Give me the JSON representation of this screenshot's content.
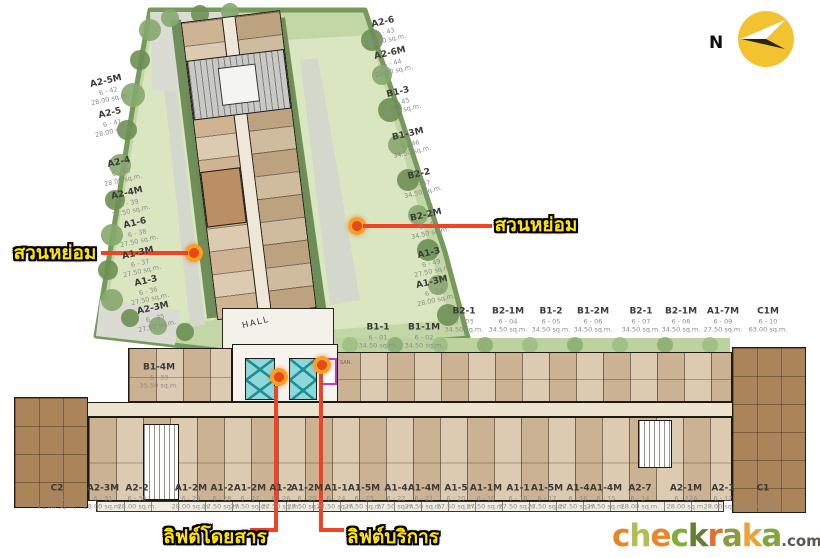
{
  "compass": {
    "n_label": "N"
  },
  "plan": {
    "hall_label": "HALL",
    "san_label": "SAN."
  },
  "colors": {
    "callout_yellow": "#ffe400",
    "connector_red": "#ef4323",
    "marker_orange_ring": "#f7a21f",
    "marker_red_core": "#e8481c",
    "lift_cyan": "#8ed8da",
    "compass_yellow": "#f2c230",
    "lawn_green": "#c3d6a6",
    "hedge_green": "#76995c",
    "unit_tan": "#d8c5a7",
    "corner_block_brown": "#ab845a"
  },
  "callouts": {
    "garden_left": "สวนหย่อม",
    "garden_right": "สวนหย่อม",
    "lift_passenger": "ลิฟต์โดยสาร",
    "lift_service": "ลิฟต์บริการ"
  },
  "units": {
    "left_column": [
      {
        "name": "A2-5M",
        "no": "6 - 42",
        "area": "28.00 sq.m.",
        "x": 108,
        "y": 90
      },
      {
        "name": "A2-5",
        "no": "6 - 41",
        "area": "28.00 sq.m.",
        "x": 112,
        "y": 122
      },
      {
        "name": "A2-4",
        "no": "6 - 40",
        "area": "28.00 sq.m.",
        "x": 121,
        "y": 171
      },
      {
        "name": "A2-4M",
        "no": "6 - 39",
        "area": "27.50 sq.m.",
        "x": 129,
        "y": 202
      },
      {
        "name": "A1-6",
        "no": "6 - 38",
        "area": "27.50 sq.m.",
        "x": 137,
        "y": 232
      },
      {
        "name": "A1-3M",
        "no": "6 - 37",
        "area": "27.50 sq.m.",
        "x": 140,
        "y": 262
      },
      {
        "name": "A1-3",
        "no": "6 - 36",
        "area": "27.50 sq.m.",
        "x": 148,
        "y": 290
      },
      {
        "name": "A2-3M",
        "no": "6 - 35",
        "area": "27.50 sq.m.",
        "x": 155,
        "y": 317
      }
    ],
    "right_column": [
      {
        "name": "A2-6",
        "no": "6 - 43",
        "area": "28.00 sq.m.",
        "x": 385,
        "y": 31
      },
      {
        "name": "A2-6M",
        "no": "6 - 44",
        "area": "28.00 sq.m.",
        "x": 392,
        "y": 62
      },
      {
        "name": "B1-3",
        "no": "6 - 45",
        "area": "34.50 sq.m.",
        "x": 400,
        "y": 101
      },
      {
        "name": "B1-3M",
        "no": "6 - 46",
        "area": "34.50 sq.m.",
        "x": 410,
        "y": 143
      },
      {
        "name": "B2-2",
        "no": "6 - 47",
        "area": "34.50 sq.m.",
        "x": 421,
        "y": 183
      },
      {
        "name": "B2-2M",
        "no": "6 - 48",
        "area": "34.50 sq.m.",
        "x": 428,
        "y": 224
      },
      {
        "name": "A1-3",
        "no": "6 - 49",
        "area": "27.50 sq.m.",
        "x": 431,
        "y": 262
      },
      {
        "name": "A1-3M",
        "no": "6 - 50",
        "area": "28.00 sq.m.",
        "x": 434,
        "y": 291
      }
    ],
    "wing_base": [
      {
        "name": "B1-1",
        "no": "6 - 01",
        "area": "34.50 sq.m.",
        "x": 378,
        "y": 336
      },
      {
        "name": "B1-1M",
        "no": "6 - 02",
        "area": "34.50 sq.m.",
        "x": 424,
        "y": 336
      }
    ],
    "misc": [
      {
        "name": "B1-4M",
        "no": "6 - 33",
        "area": "35.50 sq.m.",
        "x": 159,
        "y": 376
      }
    ],
    "top_row": [
      {
        "name": "B2-1",
        "no": "6 - 03",
        "area": "34.50 sq.m.",
        "x": 464,
        "y": 320
      },
      {
        "name": "B2-1M",
        "no": "6 - 04",
        "area": "34.50 sq.m.",
        "x": 508,
        "y": 320
      },
      {
        "name": "B1-2",
        "no": "6 - 05",
        "area": "34.50 sq.m.",
        "x": 551,
        "y": 320
      },
      {
        "name": "B1-2M",
        "no": "6 - 06",
        "area": "34.50 sq.m.",
        "x": 593,
        "y": 320
      },
      {
        "name": "B2-1",
        "no": "6 - 07",
        "area": "34.50 sq.m.",
        "x": 641,
        "y": 320
      },
      {
        "name": "B2-1M",
        "no": "6 - 08",
        "area": "34.50 sq.m.",
        "x": 681,
        "y": 320
      },
      {
        "name": "A1-7M",
        "no": "6 - 09",
        "area": "27.50 sq.m.",
        "x": 723,
        "y": 320
      },
      {
        "name": "C1M",
        "no": "6 - 10",
        "area": "63.00 sq.m.",
        "x": 768,
        "y": 320
      }
    ],
    "bottom_row": [
      {
        "name": "C2",
        "no": "6 - 32",
        "area": "71.00 sq.m.",
        "x": 57,
        "y": 497
      },
      {
        "name": "A2-3M",
        "no": "6 - 31",
        "area": "28.00 sq.m.",
        "x": 103,
        "y": 497
      },
      {
        "name": "A2-2",
        "no": "6 - 30",
        "area": "28.00 sq.m.",
        "x": 137,
        "y": 497
      },
      {
        "name": "A1-2M",
        "no": "6 - 29",
        "area": "28.00 sq.m.",
        "x": 191,
        "y": 497
      },
      {
        "name": "A1-2",
        "no": "6 - 28",
        "area": "27.50 sq.m.",
        "x": 222,
        "y": 497
      },
      {
        "name": "A1-2M",
        "no": "6 - 27",
        "area": "27.50 sq.m.",
        "x": 250,
        "y": 497
      },
      {
        "name": "A1-2",
        "no": "6 - 26",
        "area": "27.50 sq.m.",
        "x": 281,
        "y": 497
      },
      {
        "name": "A1-2M",
        "no": "6 - 25",
        "area": "27.50 sq.m.",
        "x": 307,
        "y": 497
      },
      {
        "name": "A1-1",
        "no": "6 - 24",
        "area": "27.50 sq.m.",
        "x": 336,
        "y": 497
      },
      {
        "name": "A1-5M",
        "no": "6 - 23",
        "area": "27.50 sq.m.",
        "x": 364,
        "y": 497
      },
      {
        "name": "A1-4",
        "no": "6 - 22",
        "area": "27.50 sq.m.",
        "x": 396,
        "y": 497
      },
      {
        "name": "A1-4M",
        "no": "6 - 21",
        "area": "27.50 sq.m.",
        "x": 424,
        "y": 497
      },
      {
        "name": "A1-5",
        "no": "6 - 20",
        "area": "27.50 sq.m.",
        "x": 456,
        "y": 497
      },
      {
        "name": "A1-1M",
        "no": "6 - 19",
        "area": "27.50 sq.m.",
        "x": 486,
        "y": 497
      },
      {
        "name": "A1-1",
        "no": "6 - 18",
        "area": "27.50 sq.m.",
        "x": 518,
        "y": 497
      },
      {
        "name": "A1-5M",
        "no": "6 - 17",
        "area": "27.50 sq.m.",
        "x": 547,
        "y": 497
      },
      {
        "name": "A1-4",
        "no": "6 - 16",
        "area": "27.50 sq.m.",
        "x": 578,
        "y": 497
      },
      {
        "name": "A1-4M",
        "no": "6 - 15",
        "area": "27.50 sq.m.",
        "x": 606,
        "y": 497
      },
      {
        "name": "A2-7",
        "no": "6 - 14",
        "area": "28.00 sq.m.",
        "x": 640,
        "y": 497
      },
      {
        "name": "A2-1M",
        "no": "6 - 12A",
        "area": "28.00 sq.m.",
        "x": 686,
        "y": 497
      },
      {
        "name": "A2-1",
        "no": "6 - 12",
        "area": "28.00 sq.m.",
        "x": 723,
        "y": 497
      },
      {
        "name": "C1",
        "no": "6 - 11",
        "area": "63.00 sq.m.",
        "x": 763,
        "y": 497
      }
    ]
  },
  "logo": {
    "letters": [
      {
        "ch": "c",
        "color": "#e8862b"
      },
      {
        "ch": "h",
        "color": "#b0bf4e"
      },
      {
        "ch": "e",
        "color": "#e8862b"
      },
      {
        "ch": "c",
        "color": "#7fae3f"
      },
      {
        "ch": "k",
        "color": "#647f33"
      },
      {
        "ch": "r",
        "color": "#e0712d"
      },
      {
        "ch": "a",
        "color": "#8b9c3f"
      },
      {
        "ch": "k",
        "color": "#eaa23a"
      },
      {
        "ch": "a",
        "color": "#82a63f"
      }
    ],
    "suffix": ".com"
  }
}
